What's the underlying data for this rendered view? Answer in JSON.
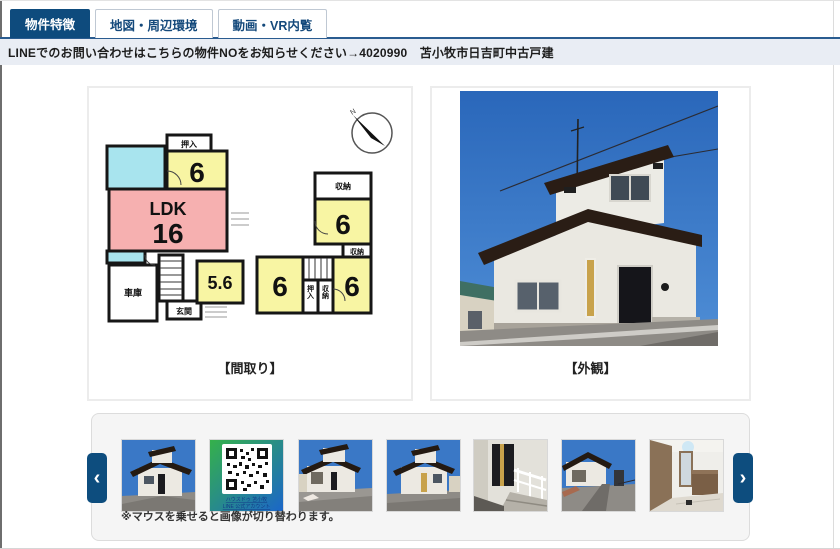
{
  "tabs": {
    "items": [
      {
        "label": "物件特徴",
        "active": true
      },
      {
        "label": "地図・周辺環境",
        "active": false
      },
      {
        "label": "動画・VR内覧",
        "active": false
      }
    ]
  },
  "notice": {
    "text": "LINEでのお問い合わせはこちらの物件NOをお知らせください→4020990　苫小牧市日吉町中古戸建"
  },
  "floorplan": {
    "caption": "【間取り】",
    "compass": "N",
    "labels": {
      "oshiire": "押入",
      "storage": "収納",
      "garage": "車庫",
      "entrance": "玄関",
      "ldk": "LDK",
      "ldk_size": "16",
      "room6": "6",
      "room56": "5.6"
    }
  },
  "exterior": {
    "caption": "【外観】"
  },
  "carousel": {
    "note": "※マウスを乗せると画像が切り替わります。",
    "prev": "‹",
    "next": "›",
    "qr": {
      "line1": "ハウスドゥ 苫小牧",
      "line2": "LINE 公式アカウント"
    }
  },
  "colors": {
    "navy": "#0e4b7d",
    "notice_bg": "#e9edf4",
    "room_yellow": "#f8f5a3",
    "room_pink": "#f6b0b0",
    "room_cyan": "#a8e4ee"
  }
}
